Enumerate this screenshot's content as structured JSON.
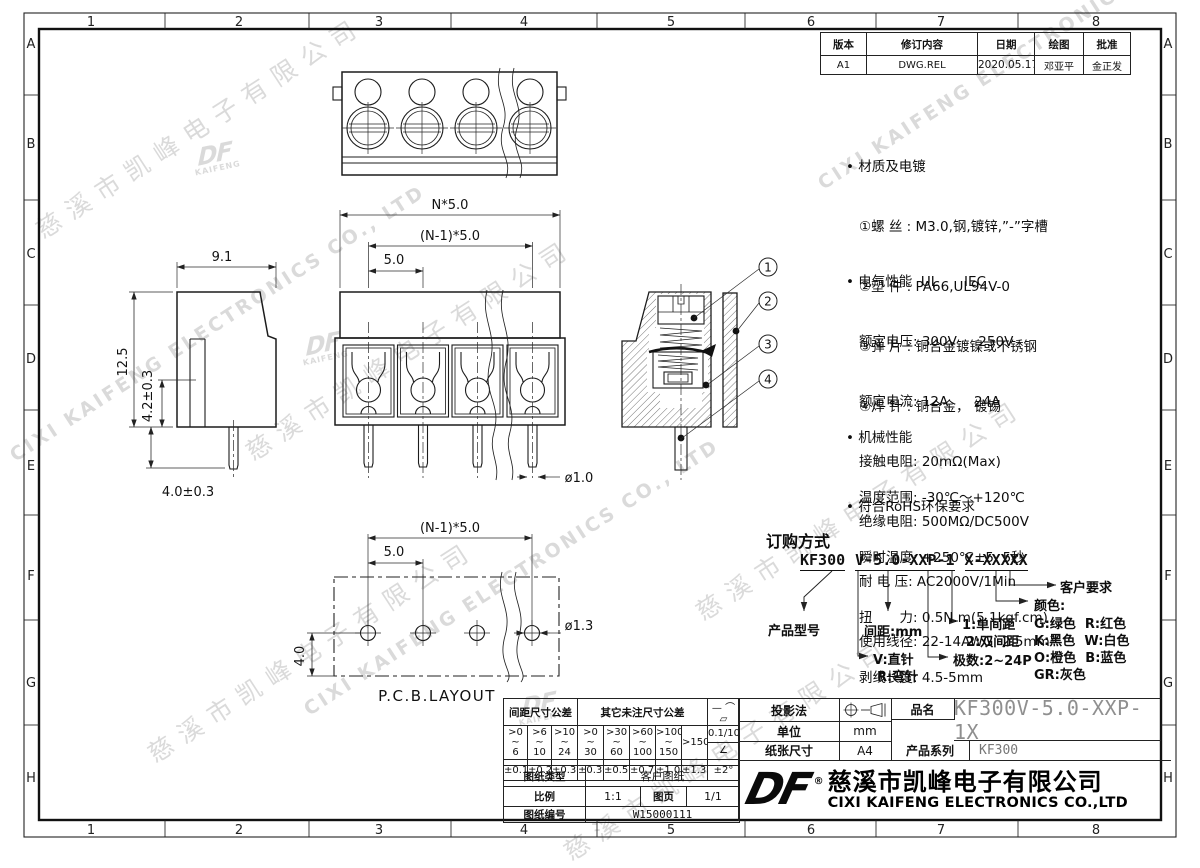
{
  "sheet": {
    "zone_cols": [
      "1",
      "2",
      "3",
      "4",
      "5",
      "6",
      "7",
      "8"
    ],
    "zone_rows": [
      "A",
      "B",
      "C",
      "D",
      "E",
      "F",
      "G",
      "H"
    ],
    "watermark_cn": "慈溪市凯峰电子有限公司",
    "watermark_en": "CIXI KAIFENG ELECTRONICS CO., LTD",
    "watermark_logo_top": "DF",
    "watermark_logo_sub": "KAIFENG"
  },
  "revision": {
    "headers": [
      "版本",
      "修订内容",
      "日期",
      "绘图",
      "批准"
    ],
    "row": [
      "A1",
      "DWG.REL",
      "2020.05.17",
      "邓亚平",
      "金正发"
    ]
  },
  "specs": {
    "material": {
      "title": "• 材质及电镀",
      "lines": [
        "①螺 丝 : M3.0,钢,镀锌,”-”字槽",
        "②塑 件 : PA66,UL94V-0",
        "③弹 片 : 铜合金镀镍或不锈钢",
        "④焊 针 : 铜合金， 镀锡"
      ]
    },
    "electrical": {
      "title": "• 电气性能  UL      IEC",
      "lines": [
        "额定电压: 300V     250V",
        "额定电流: 12A      24A",
        "接触电阻: 20mΩ(Max)",
        "绝缘电阻: 500MΩ/DC500V",
        "耐 电 压: AC2000V/1Min",
        "使用线径: 22-14AWG  2.5mm²"
      ]
    },
    "mechanical": {
      "title": "• 机械性能",
      "lines": [
        "温度范围: -30℃～+120℃",
        "瞬时温度: +250℃±5  5秒",
        "扭　　力: 0.5N.m(5.1kgf.cm)",
        "剥线长度: 4.5-5mm"
      ]
    },
    "rohs": "• 符合RoHS环保要求"
  },
  "ordering": {
    "title": "订购方式",
    "model_parts": [
      "KF300",
      "V-5.0-XXP-1",
      "X-XXXXX"
    ],
    "labels": {
      "product_model": "产品型号",
      "pin_type": [
        "V:直针",
        "R:弯针"
      ],
      "pitch": "间距:mm",
      "poles": "极数:2~24P",
      "spacing": [
        "1:单间距",
        "2:双间距"
      ],
      "color_title": "颜色:",
      "colors": [
        "G:绿色  R:红色",
        "K:黑色  W:白色",
        "O:橙色  B:蓝色",
        "GR:灰色"
      ],
      "customer": "客户要求"
    }
  },
  "dims": {
    "n50": "N*5.0",
    "n150": "(N-1)*5.0",
    "p50": "5.0",
    "w91": "9.1",
    "h125": "12.5",
    "h42": "4.2±0.3",
    "l40": "4.0±0.3",
    "d10": "ø1.0",
    "pcb_n150": "(N-1)*5.0",
    "pcb_50": "5.0",
    "pcb_d13": "ø1.3",
    "pcb_40": "4.0",
    "pcb_label": "P.C.B.LAYOUT",
    "b1": "1",
    "b2": "2",
    "b3": "3",
    "b4": "4"
  },
  "tb": {
    "pitch_tol_header": "间距尺寸公差",
    "other_tol_header": "其它未注尺寸公差",
    "ranges": [
      ">0\n~\n6",
      ">6\n~\n10",
      ">10\n~\n24",
      ">0\n~\n30",
      ">30\n~\n60",
      ">60\n~\n100",
      ">100\n~\n150",
      ">150"
    ],
    "tols": [
      "±0.15",
      "±0.20",
      "±0.30",
      "±0.30",
      "±0.50",
      "±0.70",
      "±1.00",
      "±1.30"
    ],
    "flat_symbols": "— ⌒ ▱",
    "flatness": "0.1/10",
    "angle_symbol": "∠",
    "angle_tol": "±2°",
    "doc_type_label": "图纸类型",
    "doc_type": "客户图纸",
    "scale_label": "比例",
    "scale": "1:1",
    "page_label": "图页",
    "page": "1/1",
    "doc_no_label": "图纸编号",
    "doc_no": "W15000111",
    "projection_label": "投影法",
    "unit_label": "单位",
    "unit": "mm",
    "paper_label": "纸张尺寸",
    "paper": "A4",
    "name_label": "品名",
    "name": "KF300V-5.0-XXP-1X",
    "series_label": "产品系列",
    "series": "KF300",
    "logo": "DF",
    "reg": "®",
    "company_cn": "慈溪市凯峰电子有限公司",
    "company_en": "CIXI KAIFENG ELECTRONICS CO.,LTD"
  }
}
